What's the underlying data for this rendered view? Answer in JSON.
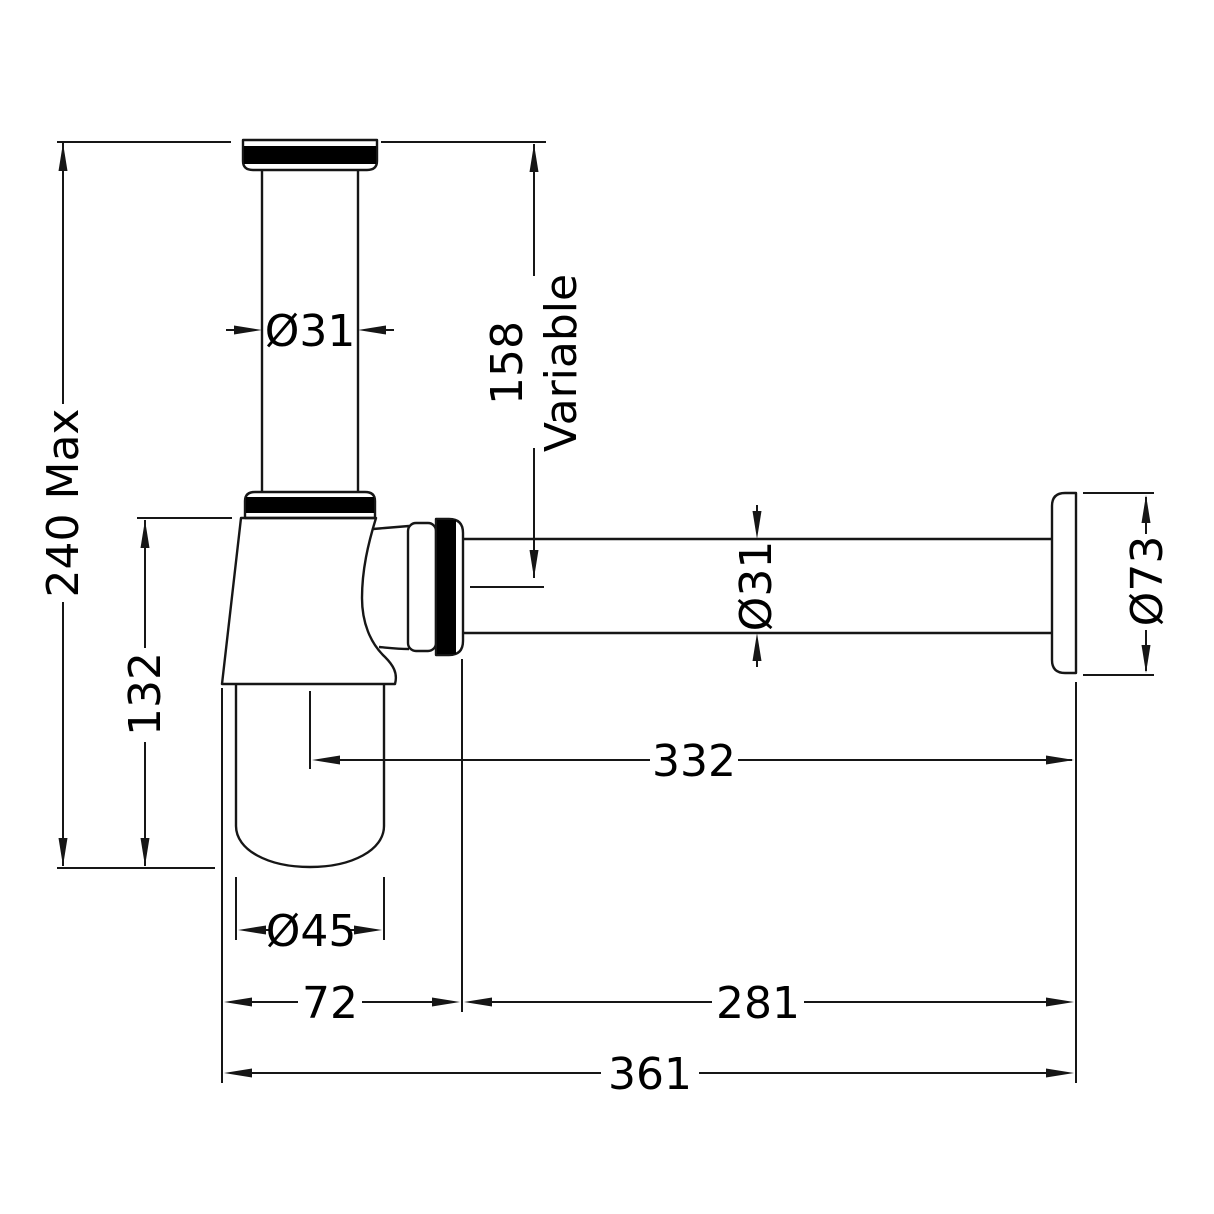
{
  "drawing": {
    "labels": {
      "overall_height": "240 Max",
      "trap_height": "132",
      "inlet_diameter": "Ø31",
      "inlet_length": "158",
      "inlet_length_note": "Variable",
      "outlet_diameter": "Ø31",
      "flange_diameter": "Ø73",
      "bottle_diameter": "Ø45",
      "bottle_centre_to_wall": "332",
      "trap_width": "72",
      "outlet_projection": "281",
      "overall_projection": "361"
    },
    "colors": {
      "line": "#161616",
      "seal_band": "#000000",
      "background": "#ffffff"
    }
  }
}
